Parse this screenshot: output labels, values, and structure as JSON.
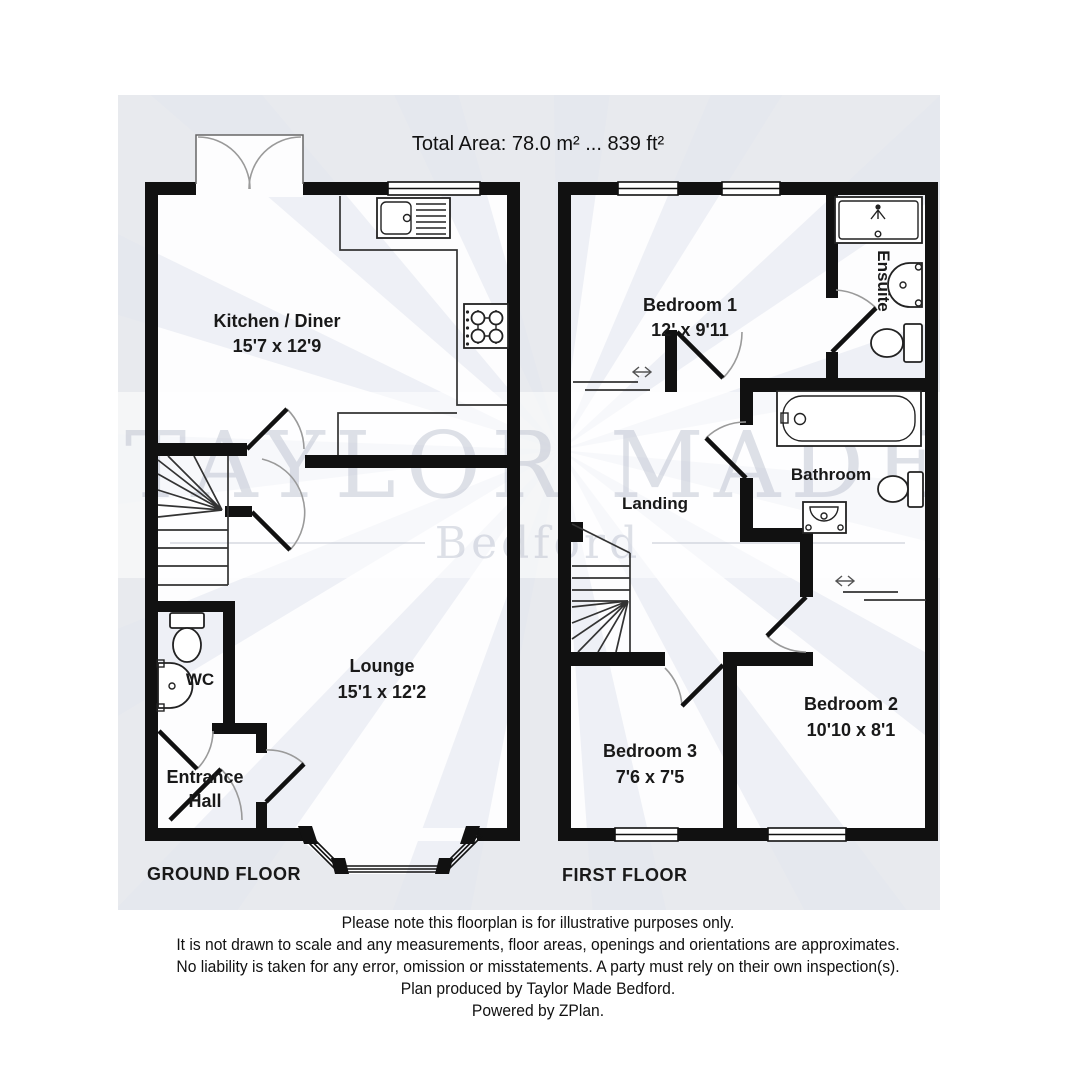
{
  "title": "Total Area: 78.0 m² ... 839 ft²",
  "watermark": {
    "line1": "TAYLOR MADE",
    "line2": "Bedford"
  },
  "floors": {
    "ground": {
      "caption": "GROUND FLOOR",
      "rooms": {
        "kitchen": {
          "name": "Kitchen / Diner",
          "dims": "15'7 x 12'9"
        },
        "lounge": {
          "name": "Lounge",
          "dims": "15'1 x 12'2"
        },
        "wc": {
          "name": "WC"
        },
        "hall": {
          "name_line1": "Entrance",
          "name_line2": "Hall"
        }
      }
    },
    "first": {
      "caption": "FIRST FLOOR",
      "rooms": {
        "bedroom1": {
          "name": "Bedroom 1",
          "dims": "12' x 9'11"
        },
        "bedroom2": {
          "name": "Bedroom 2",
          "dims": "10'10 x 8'1"
        },
        "bedroom3": {
          "name": "Bedroom 3",
          "dims": "7'6 x 7'5"
        },
        "ensuite": {
          "name": "Ensuite"
        },
        "bathroom": {
          "name": "Bathroom"
        },
        "landing": {
          "name": "Landing"
        }
      }
    }
  },
  "footer": {
    "lines": [
      "Please note this floorplan is for illustrative purposes only.",
      "It is not drawn to scale and any measurements, floor areas, openings and orientations are approximates.",
      "No liability is taken for any error, omission or misstatements. A party must rely on their own inspection(s).",
      "Plan produced by Taylor Made Bedford.",
      "Powered by ZPlan."
    ]
  },
  "icons": {
    "kitchen_sink": "sink-with-drainer-icon",
    "hob": "four-burner-hob-icon",
    "toilet": "toilet-icon",
    "basin": "wash-basin-icon",
    "bath": "bathtub-icon",
    "shower": "shower-tray-icon",
    "stairs": "staircase-icon",
    "wardrobe": "sliding-wardrobe-arrow-icon",
    "window": "window-icon",
    "door": "door-swing-icon"
  },
  "colors": {
    "panel_bg": "#e8eaee",
    "wall": "#111111",
    "room_bg": "#ffffff",
    "door_arc": "#9a9a9a",
    "watermark": "#aab1c2",
    "text": "#191919"
  }
}
